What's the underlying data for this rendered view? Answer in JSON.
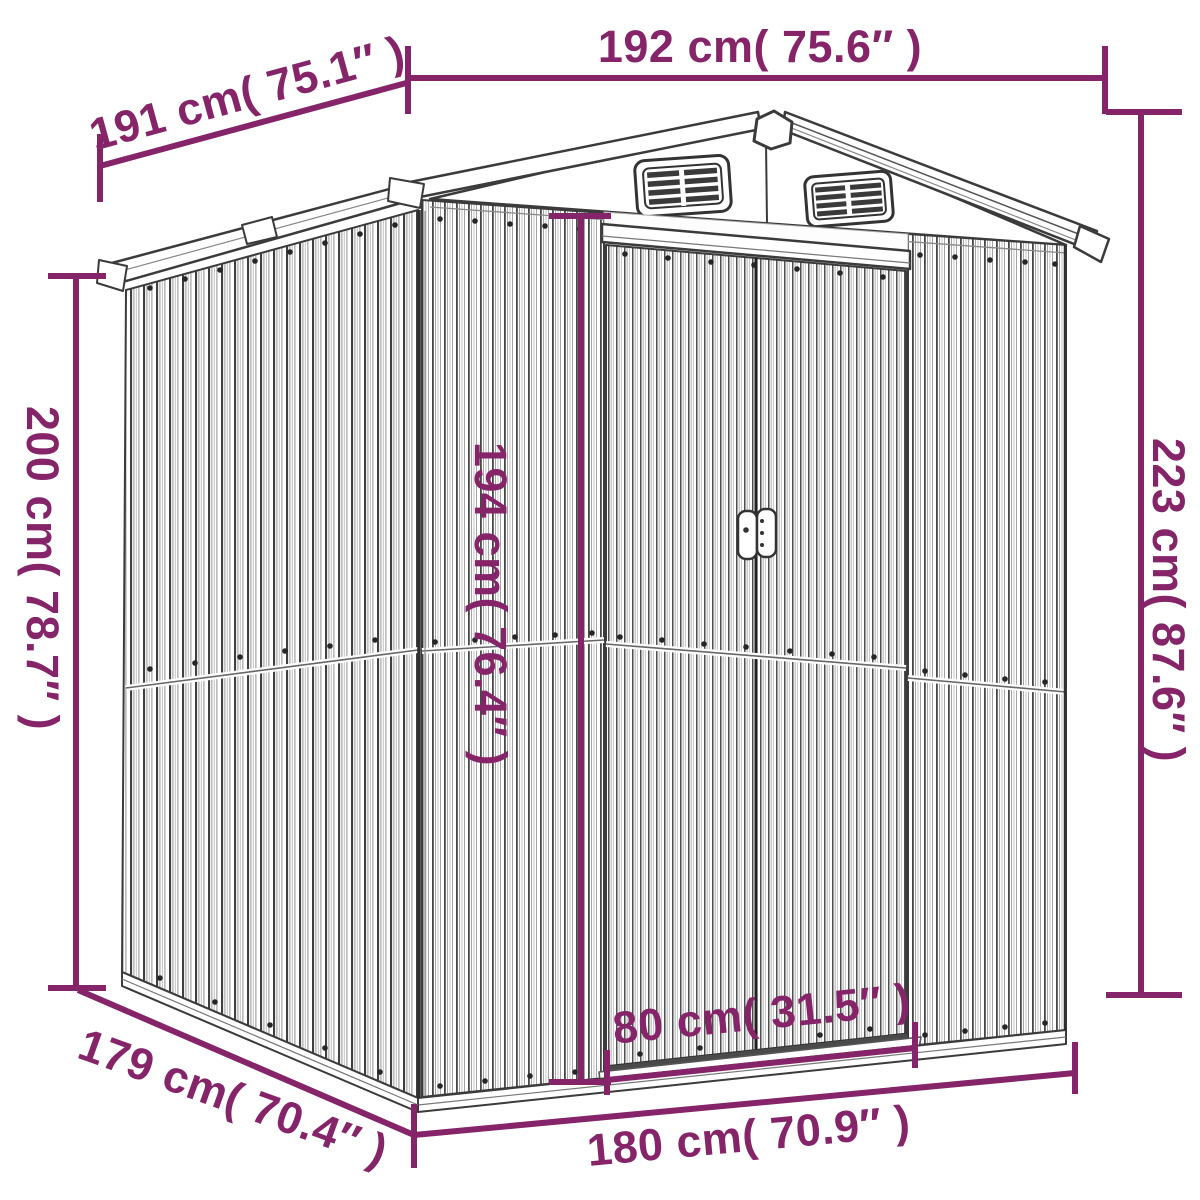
{
  "diagram": {
    "type": "product-dimension-diagram",
    "subject": "metal garden shed line drawing with measurements",
    "accent_color": "#862469",
    "line_color": "#3b3b3b",
    "background_color": "#ffffff",
    "labels": {
      "top_width": "192 cm( 75.6″ )",
      "roof_depth": "191 cm( 75.1″ )",
      "left_height": "200 cm( 78.7″ )",
      "door_height": "194 cm( 76.4″ )",
      "right_height": "223 cm( 87.6″ )",
      "base_depth": "179 cm( 70.4″ )",
      "door_width": "80 cm( 31.5″ )",
      "base_width": "180 cm( 70.9″ )"
    },
    "measurements": {
      "top_width_cm": 192,
      "top_width_in": 75.6,
      "roof_depth_cm": 191,
      "roof_depth_in": 75.1,
      "left_height_cm": 200,
      "left_height_in": 78.7,
      "door_height_cm": 194,
      "door_height_in": 76.4,
      "right_height_cm": 223,
      "right_height_in": 87.6,
      "base_depth_cm": 179,
      "base_depth_in": 70.4,
      "door_width_cm": 80,
      "door_width_in": 31.5,
      "base_width_cm": 180,
      "base_width_in": 70.9
    }
  }
}
